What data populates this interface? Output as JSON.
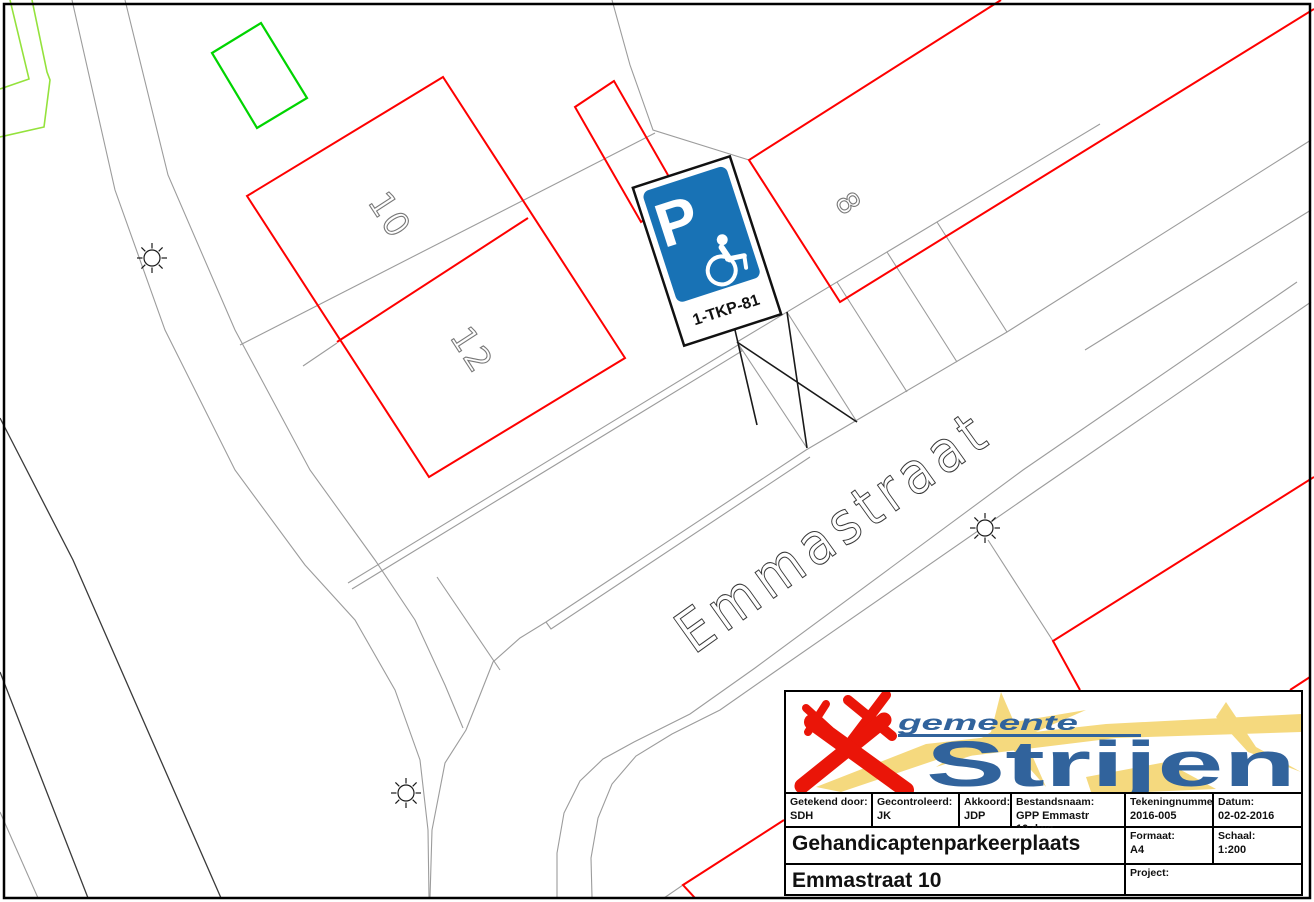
{
  "map": {
    "street_label": "Emmastraat",
    "house_numbers": {
      "n10": "10",
      "n12": "12",
      "n8": "8"
    },
    "sign": {
      "p_label": "P",
      "code_label": "1-TKP-81",
      "panel_color": "#1872b5",
      "plate_color": "#ffffff"
    },
    "colors": {
      "building_red": "#fe0000",
      "plot_green": "#00d400",
      "veg_lightgreen": "#94e23c",
      "road_gray": "#9c9c9c",
      "line_dark": "#3a3a3a",
      "mark_black": "#1a1a1a",
      "number_gray": "#787878",
      "frame_black": "#000000"
    }
  },
  "titleblock": {
    "logo": {
      "word_top": "gemeente",
      "word_main": "Strijen",
      "blue": "#31639c",
      "red": "#ea1508",
      "yellow": "#f5d97e"
    },
    "fields": {
      "drawn_label": "Getekend door:",
      "drawn": "SDH",
      "checked_label": "Gecontroleerd:",
      "checked": "JK",
      "approved_label": "Akkoord:",
      "approved": "JDP",
      "file_label": "Bestandsnaam:",
      "file": "GPP Emmastr 10.dwg",
      "number_label": "Tekeningnummer:",
      "number": "2016-005",
      "date_label": "Datum:",
      "date": "02-02-2016",
      "format_label": "Formaat:",
      "format": "A4",
      "scale_label": "Schaal:",
      "scale": "1:200",
      "project_label": "Project:",
      "project": ""
    },
    "title_line1": "Gehandicaptenparkeerplaats",
    "title_line2": "Emmastraat 10"
  }
}
